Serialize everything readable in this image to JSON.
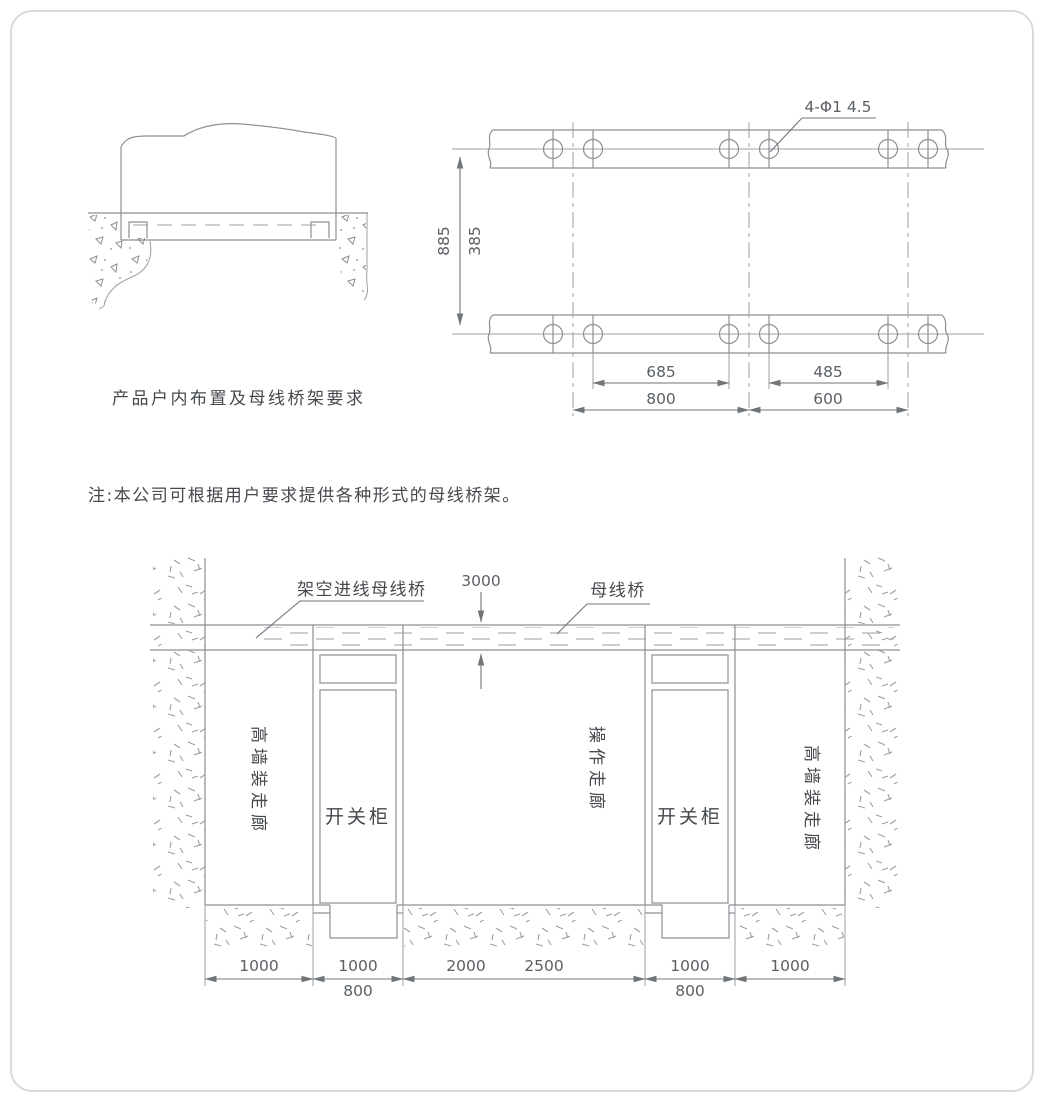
{
  "page": {
    "background": "#ffffff",
    "border_color": "#d8dadb",
    "line_color": "#8b9094",
    "text_color": "#45494d"
  },
  "elevation": {
    "caption": "产品户内布置及母线桥架要求"
  },
  "plan": {
    "hole_label": "4-Φ1 4.5",
    "dim_outer_vertical": "885",
    "dim_inner_vertical": "385",
    "dim_hole_span_left": "685",
    "dim_segment_left": "800",
    "dim_hole_span_right": "485",
    "dim_segment_right": "600"
  },
  "note": "注:本公司可根据用户要求提供各种形式的母线桥架。",
  "layout": {
    "overhead_busbar_label": "架空进线母线桥",
    "busbar_height_dim": "3000",
    "busbar_label": "母线桥",
    "left_corridor_label": "高墙装走廊",
    "right_corridor_label": "高墙装走廊",
    "operation_corridor_label": "操作走廊",
    "left_cabinet_label": "开关柜",
    "right_cabinet_label": "开关柜",
    "dim_left_corridor": "1000",
    "dim_left_cabinet": "1000",
    "dim_left_cabinet_alt": "800",
    "dim_operation": "2000",
    "dim_operation_alt": "2500",
    "dim_right_cabinet": "1000",
    "dim_right_cabinet_alt": "800",
    "dim_right_corridor": "1000"
  }
}
